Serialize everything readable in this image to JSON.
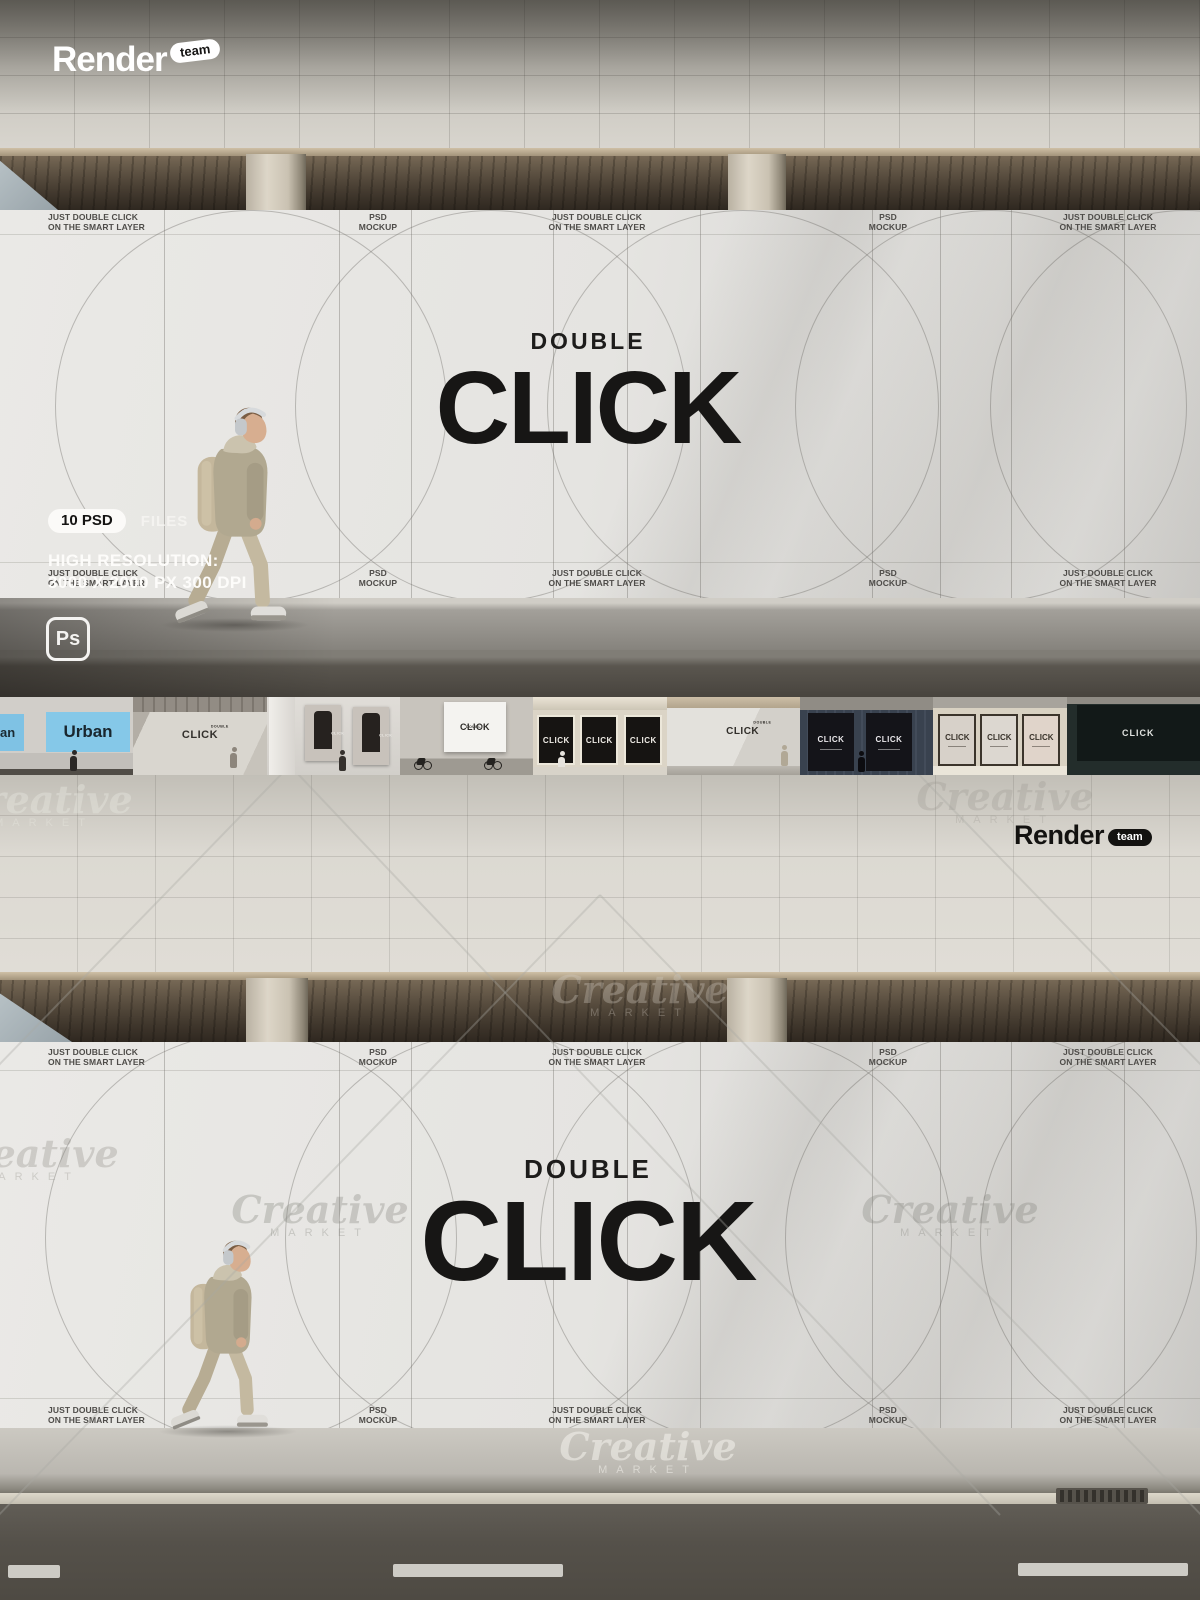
{
  "brand": {
    "name": "Render",
    "badge": "team"
  },
  "billboard": {
    "note_line1": "JUST DOUBLE CLICK",
    "note_line2": "ON THE SMART LAYER",
    "psd_line1": "PSD",
    "psd_line2": "MOCKUP",
    "headline_small": "DOUBLE",
    "headline_large": "CLICK"
  },
  "info": {
    "files_badge": "10 PSD",
    "files_label": "FILES",
    "resolution_line1": "HIGH RESOLUTION:",
    "resolution_line2": "3000 X 2000 PX 300 DPI",
    "photoshop_badge": "Ps"
  },
  "watermark": {
    "word1": "Creative",
    "word2": "MARKET"
  },
  "colors": {
    "urban_poster_blue": "#85c8e8",
    "billboard_white": "#e7e6e3",
    "headline_black": "#171615"
  },
  "thumbnails": [
    {
      "name": "urban-blue-posters",
      "poster_text": "Urban",
      "poster_text_partial": "an"
    },
    {
      "name": "underpass-wall",
      "headline_small": "DOUBLE",
      "poster_text": "CLICK"
    },
    {
      "name": "framed-portrait-posters",
      "poster_text": "CLICK"
    },
    {
      "name": "square-poster-cyclists",
      "headline_small": "DOUBLE",
      "poster_text": "CLICK"
    },
    {
      "name": "storefront-dark-windows",
      "poster_text": "CLICK"
    },
    {
      "name": "long-white-wall",
      "headline_small": "DOUBLE",
      "poster_text": "CLICK"
    },
    {
      "name": "navy-storefront-posters",
      "poster_text": "CLICK"
    },
    {
      "name": "beige-storefront-posters",
      "poster_text": "CLICK"
    },
    {
      "name": "dark-night-billboard",
      "poster_text": "CLICK"
    }
  ]
}
